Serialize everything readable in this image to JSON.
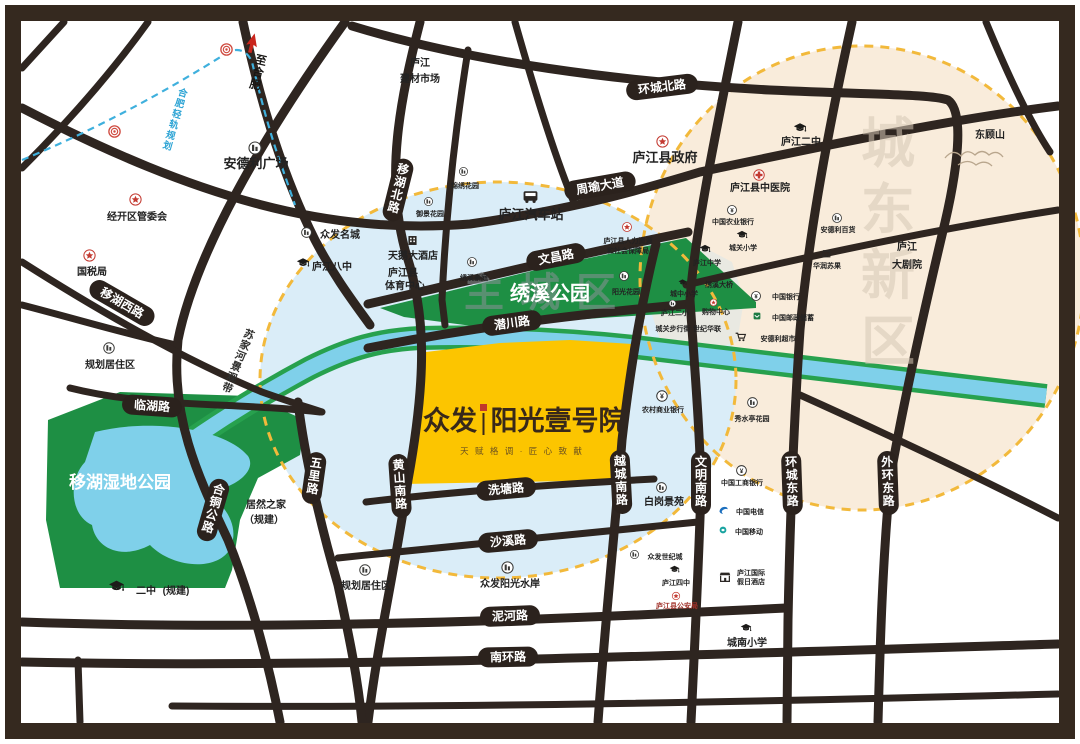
{
  "project": {
    "brand": "众发",
    "name": "阳光壹号院",
    "tagline": "天 赋 格 调 · 匠 心 致 献"
  },
  "watermarks": {
    "old_town": "主城区",
    "new_district": "城东新区"
  },
  "parks": {
    "xiuxi": "绣溪公园",
    "wetland": "移湖湿地公园"
  },
  "roads": {
    "huancheng_bei": "环城北路",
    "zhouyu": "周瑜大道",
    "wenchang": "文昌路",
    "qianchuan": "潜川路",
    "xitang": "洗塘路",
    "shaxi": "沙溪路",
    "nihe": "泥河路",
    "nanhuan": "南环路",
    "yihu_xi": "移湖西路",
    "linhu": "临湖路",
    "yihu_bei": "移湖北路",
    "hetong": "合铜公路",
    "wuli": "五里路",
    "huangshan_nan": "黄山南路",
    "yuecheng_nan": "越城南路",
    "wenming_nan": "文明南路",
    "huancheng_dong": "环城东路",
    "waihuan_dong": "外环东路",
    "to_hefei": "至合肥",
    "rail": "合肥轻轨规划",
    "sujiahe": "苏家河景观带"
  },
  "pois": {
    "andeli_plaza": {
      "label": "安德利广场"
    },
    "jingkaiqu": {
      "label": "经开区管委会"
    },
    "guoshuiju": {
      "label": "国税局"
    },
    "jiancai": {
      "label": "庐江",
      "label2": "建材市场"
    },
    "zf_mingcheng": {
      "label": "众发名城"
    },
    "lj_bazhong": {
      "label": "庐江八中"
    },
    "guihua1": {
      "label": "规划居住区"
    },
    "guihua2": {
      "label": "规划居住区"
    },
    "juran": {
      "label": "居然之家",
      "label2": "（规建）"
    },
    "erzhong": {
      "label": "二中",
      "label2": "(规建)"
    },
    "bus": {
      "label": "庐江汽车站"
    },
    "hotel_tiane": {
      "label": "天鹅大酒店"
    },
    "sports": {
      "label": "庐江县",
      "label2": "体育中心"
    },
    "garden_a": {
      "label": "锦绣花园"
    },
    "garden_b": {
      "label": "御景花园"
    },
    "renshe": {
      "label": "庐江县人力资源",
      "label2": "和社会保障局"
    },
    "haoting": {
      "label": "绣溪豪庭"
    },
    "yg_garden": {
      "label": "阳光花园"
    },
    "gov": {
      "label": "庐江县政府"
    },
    "lj_erzhong": {
      "label": "庐江二中"
    },
    "zhongyi": {
      "label": "庐江县中医院"
    },
    "abc_bank": {
      "label": "中国农业银行"
    },
    "chengguan": {
      "label": "城关小学"
    },
    "lj_zhongxue": {
      "label": "庐江中学"
    },
    "andeli_bh": {
      "label": "安德利百货"
    },
    "suguo": {
      "label": "华润苏果"
    },
    "boc": {
      "label": "中国银行"
    },
    "post": {
      "label": "中国邮政储蓄"
    },
    "andeli_cs": {
      "label": "安德利超市"
    },
    "theater": {
      "label": "庐江",
      "label2": "大剧院"
    },
    "dongguhan": {
      "label": "东顾山"
    },
    "rcb": {
      "label": "农村商业银行"
    },
    "xiushuiting": {
      "label": "秀水亭花园"
    },
    "baigang": {
      "label": "白岗景苑"
    },
    "icbc": {
      "label": "中国工商银行"
    },
    "telecom": {
      "label": "中国电信"
    },
    "mobile": {
      "label": "中国移动"
    },
    "holiday": {
      "label": "庐江国际",
      "label2": "假日酒店"
    },
    "shuian": {
      "label": "众发阳光水岸"
    },
    "shiji": {
      "label": "众发世纪城"
    },
    "sizhong": {
      "label": "庐江四中"
    },
    "gongan": {
      "label": "庐江县公安局"
    },
    "chengnan": {
      "label": "城南小学"
    },
    "g1": {
      "label": "城中小学"
    },
    "g2": {
      "label": "绣溪大桥"
    },
    "g3": {
      "label": "庐江二小"
    },
    "g4": {
      "label": "购物中心"
    },
    "g5": {
      "label": "城关步行街"
    },
    "g6": {
      "label": "世纪华联"
    }
  }
}
